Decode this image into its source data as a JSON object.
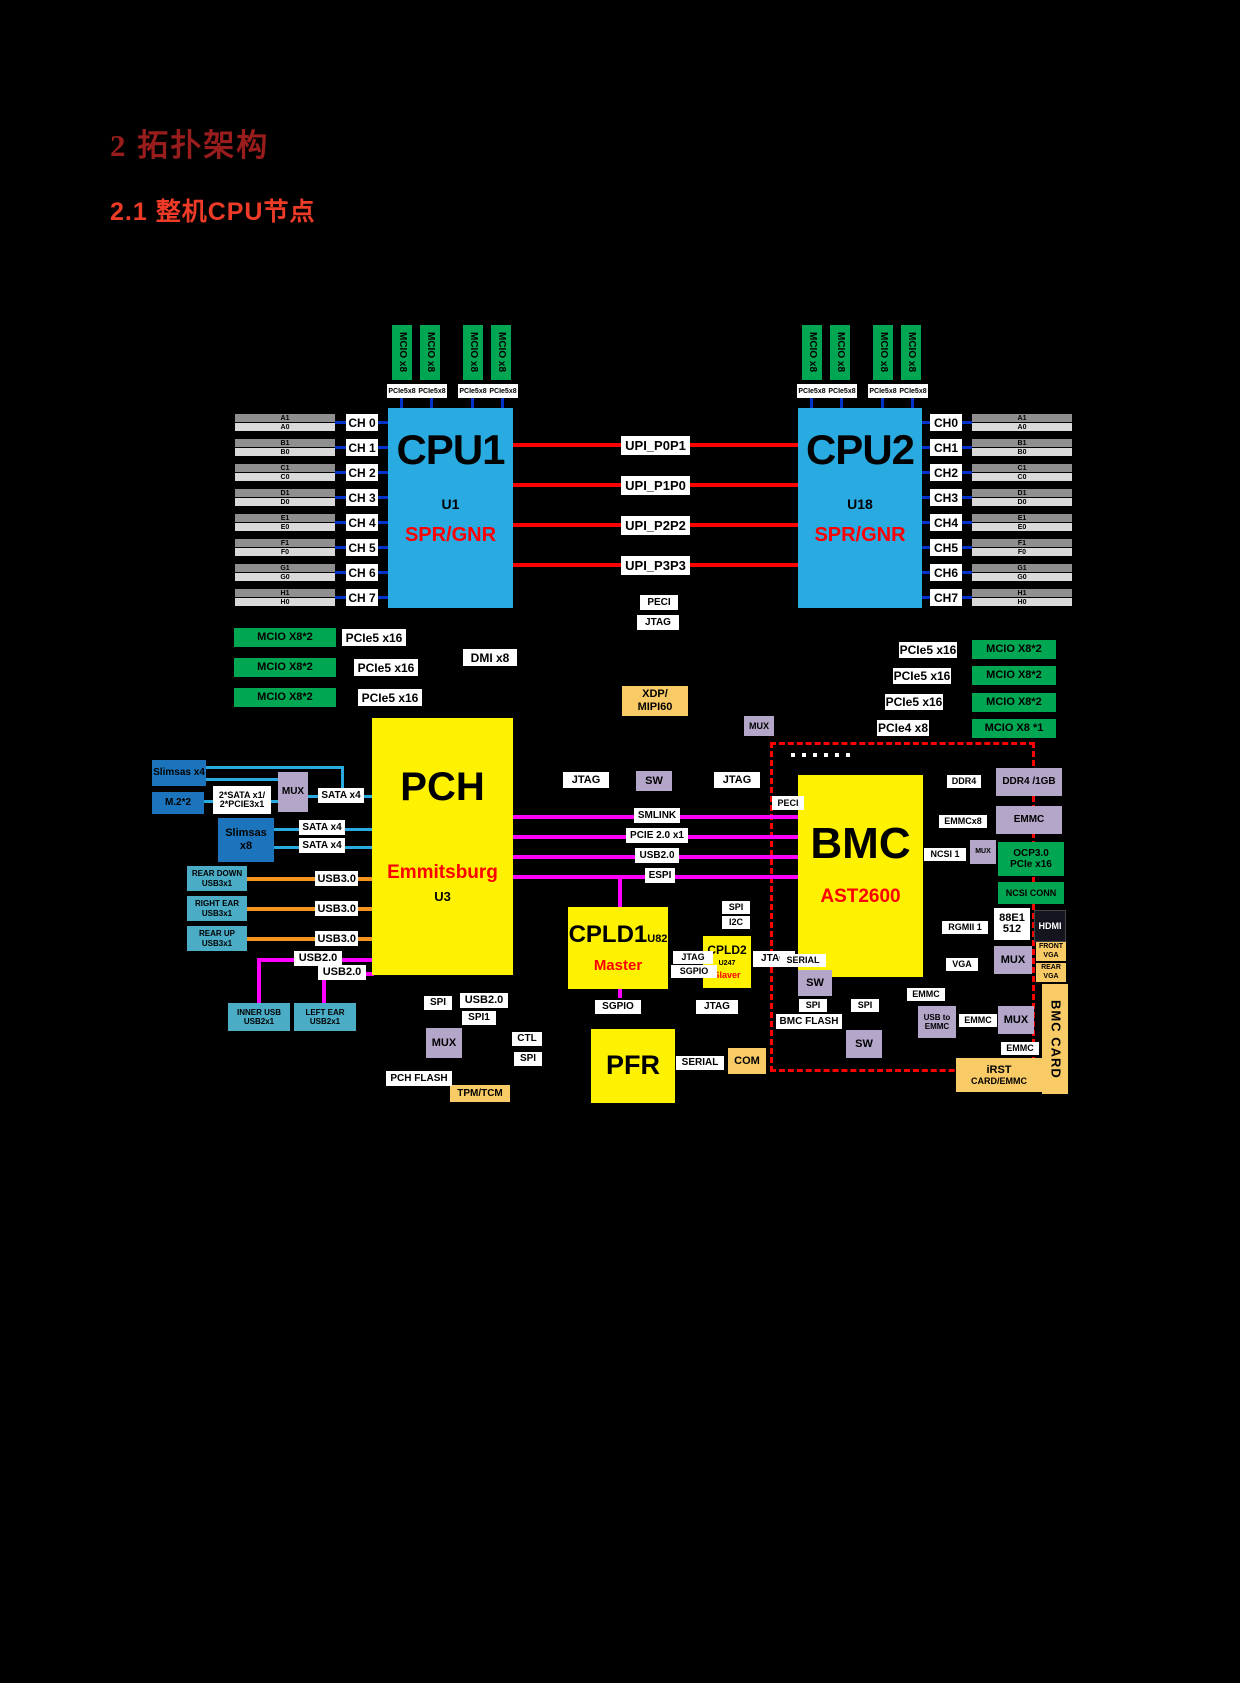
{
  "page": {
    "background": "#000000"
  },
  "headings": {
    "h1": "2  拓扑架构",
    "h2": "2.1  整机CPU节点"
  },
  "colors": {
    "cpu_block": "#29ABE2",
    "logic_block": "#FFF200",
    "mcio_green": "#00A651",
    "mux_purple": "#B3A6C9",
    "usb_teal": "#4BACC6",
    "storage_blue": "#1C75BC",
    "connector_tan": "#F9CB67",
    "upi_red": "#FF0000",
    "channel_blue": "#0033CC",
    "sata_cyan": "#29ABE2",
    "usb3_orange": "#F7941D",
    "usb2_magenta": "#FF00FF",
    "bmc_card_border": "#FF0000",
    "heading1": "#9A1D1D",
    "heading2": "#EE3B28"
  },
  "labels": {
    "mcio_x8": "MCIO x8",
    "pcie5x8": "PCIe5x8"
  },
  "cpu1": {
    "title": "CPU1",
    "ref": "U1",
    "arch": "SPR/GNR"
  },
  "cpu2": {
    "title": "CPU2",
    "ref": "U18",
    "arch": "SPR/GNR"
  },
  "channels_left": [
    {
      "ch": "CH 0",
      "top": "A1",
      "bot": "A0"
    },
    {
      "ch": "CH 1",
      "top": "B1",
      "bot": "B0"
    },
    {
      "ch": "CH 2",
      "top": "C1",
      "bot": "C0"
    },
    {
      "ch": "CH 3",
      "top": "D1",
      "bot": "D0"
    },
    {
      "ch": "CH 4",
      "top": "E1",
      "bot": "E0"
    },
    {
      "ch": "CH 5",
      "top": "F1",
      "bot": "F0"
    },
    {
      "ch": "CH 6",
      "top": "G1",
      "bot": "G0"
    },
    {
      "ch": "CH 7",
      "top": "H1",
      "bot": "H0"
    }
  ],
  "channels_right": [
    {
      "ch": "CH0",
      "top": "A1",
      "bot": "A0"
    },
    {
      "ch": "CH1",
      "top": "B1",
      "bot": "B0"
    },
    {
      "ch": "CH2",
      "top": "C1",
      "bot": "C0"
    },
    {
      "ch": "CH3",
      "top": "D1",
      "bot": "D0"
    },
    {
      "ch": "CH4",
      "top": "E1",
      "bot": "E0"
    },
    {
      "ch": "CH5",
      "top": "F1",
      "bot": "F0"
    },
    {
      "ch": "CH6",
      "top": "G1",
      "bot": "G0"
    },
    {
      "ch": "CH7",
      "top": "H1",
      "bot": "H0"
    }
  ],
  "upi_links": [
    {
      "label": "UPI_P0P1"
    },
    {
      "label": "UPI_P1P0"
    },
    {
      "label": "UPI_P2P2"
    },
    {
      "label": "UPI_P3P3"
    }
  ],
  "cpu_misc": {
    "peci": "PECI",
    "jtag": "JTAG",
    "dmi": "DMI x8"
  },
  "left_io": [
    {
      "mcio": "MCIO X8*2",
      "pcie": "PCIe5 x16"
    },
    {
      "mcio": "MCIO X8*2",
      "pcie": "PCIe5 x16"
    },
    {
      "mcio": "MCIO X8*2",
      "pcie": "PCIe5 x16"
    }
  ],
  "right_io": [
    {
      "pcie": "PCIe5 x16",
      "mcio": "MCIO X8*2"
    },
    {
      "pcie": "PCIe5 x16",
      "mcio": "MCIO X8*2"
    },
    {
      "pcie": "PCIe5 x16",
      "mcio": "MCIO X8*2"
    },
    {
      "pcie": "PCIe4 x8",
      "mcio": "MCIO X8 *1"
    }
  ],
  "xdp": {
    "line1": "XDP/",
    "line2": "MIPI60"
  },
  "mux_top": "MUX",
  "pch": {
    "title": "PCH",
    "sub": "Emmitsburg",
    "ref": "U3"
  },
  "storage": {
    "slimsas4": "Slimsas x4",
    "m2": "M.2*2",
    "adapter1": "2*SATA x1/",
    "adapter2": "2*PCIE3x1",
    "mux": "MUX",
    "sata_out": "SATA x4",
    "slimsas8": "Slimsas x8",
    "sata1": "SATA x4",
    "sata2": "SATA x4"
  },
  "usb3_ports": [
    {
      "l1": "REAR DOWN",
      "l2": "USB3x1",
      "bus": "USB3.0"
    },
    {
      "l1": "RIGHT EAR",
      "l2": "USB3x1",
      "bus": "USB3.0"
    },
    {
      "l1": "REAR UP",
      "l2": "USB3x1",
      "bus": "USB3.0"
    }
  ],
  "usb2_ports": [
    {
      "l1": "INNER USB",
      "l2": "USB2x1",
      "bus": "USB2.0"
    },
    {
      "l1": "LEFT EAR",
      "l2": "USB2x1",
      "bus": "USB2.0"
    }
  ],
  "pch_bottom": {
    "spi": "SPI",
    "usb20": "USB2.0",
    "spi1": "SPI1",
    "mux": "MUX",
    "flash": "PCH FLASH",
    "tpm": "TPM/TCM",
    "ctl": "CTL",
    "spi2": "SPI"
  },
  "pch_bmc_links": {
    "jtag_a": "JTAG",
    "sw": "SW",
    "jtag_b": "JTAG",
    "smlink": "SMLINK",
    "pcie20": "PCIE 2.0 x1",
    "usb20": "USB2.0",
    "espi": "ESPI"
  },
  "cpld1": {
    "title": "CPLD1",
    "ref": "U82",
    "role": "Master"
  },
  "cpld2": {
    "title": "CPLD2",
    "ref": "U247",
    "role": "Slaver"
  },
  "cpld_misc": {
    "spi": "SPI",
    "i2c": "I2C",
    "jtag": "JTAG",
    "sgpio": "SGPIO",
    "sgpio_b": "SGPIO",
    "jtag_b": "JTAG",
    "jtag_card": "JTAG"
  },
  "pfr": {
    "title": "PFR",
    "serial": "SERIAL",
    "com": "COM"
  },
  "bmc": {
    "title": "BMC",
    "chip": "AST2600",
    "peci": "PECI",
    "signals": [
      {
        "label": "I2C"
      },
      {
        "label": "I3C"
      },
      {
        "label": "UART"
      },
      {
        "label": "ADC"
      },
      {
        "label": "TACH"
      },
      {
        "label": "PWM"
      }
    ]
  },
  "bmc_flash_group": {
    "serial": "SERIAL",
    "sw": "SW",
    "spi": "SPI",
    "flash": "BMC FLASH"
  },
  "bmc_io": {
    "ddr4": "DDR4",
    "emmcx8": "EMMCx8",
    "ncsi": "NCSI 1",
    "mux_small": "MUX",
    "rgmii": "RGMII 1",
    "vga": "VGA",
    "emmc_a": "EMMC",
    "spi": "SPI",
    "sw": "SW",
    "usb2emmc_l1": "USB to",
    "usb2emmc_l2": "EMMC",
    "emmc_b": "EMMC",
    "mux": "MUX",
    "emmc_c": "EMMC"
  },
  "right_col": {
    "ddr": "DDR4 /1GB",
    "emmc": "EMMC",
    "ocp1": "OCP3.0",
    "ocp2": "PCIe x16",
    "ncsi_conn": "NCSI CONN",
    "phy1": "88E1",
    "phy2": "512",
    "hdmi": "HDMI",
    "mux": "MUX",
    "front1": "FRONT",
    "front2": "VGA",
    "rear1": "REAR",
    "rear2": "VGA"
  },
  "card": {
    "strip": "BMC CARD",
    "irst1": "iRST",
    "irst2": "CARD/EMMC"
  }
}
